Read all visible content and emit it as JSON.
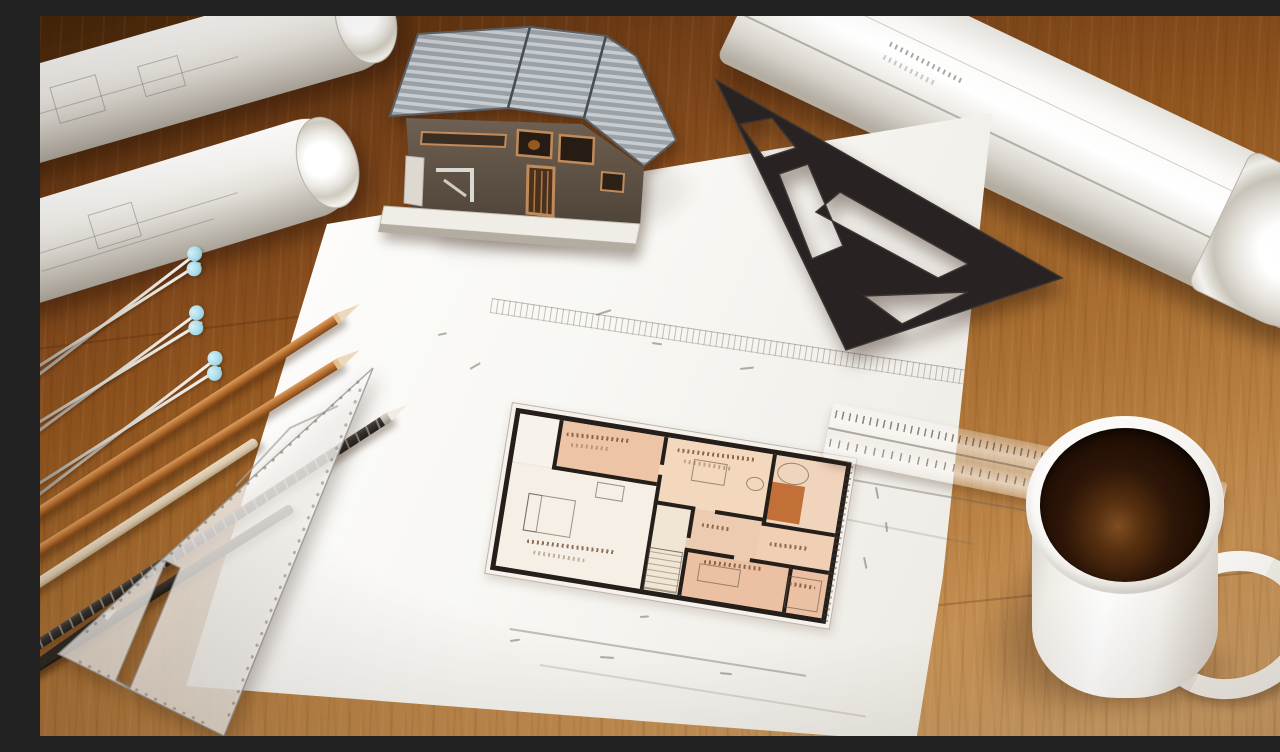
{
  "scene": {
    "description": "Top-down photo of an architect's wooden desk: two rolled blueprints top-left, a miniature house model with corrugated metal roof, a large rolled blueprint at top-right, a black drafting set square, a hand-drawn floor plan with peach colored rooms on a white sheet, copper and black pencils, silver drafting compasses with blue grips, a translucent triangle ruler, a translucent scale ruler, and a white mug of black coffee",
    "surface_label": "wooden desk",
    "visible_text": "none legible (handwritten plan labels and dimension figures are illegible scribbles)"
  },
  "palette": {
    "wood1": "#452608",
    "wood2": "#5f3310",
    "wood3": "#7b441a",
    "wood4": "#93561f",
    "wood5": "#a56a2d",
    "wood6": "#b57c3e",
    "wood7": "#c48f52",
    "wood8": "#cd9e66",
    "paper": "#f8f7f3",
    "paper_edge": "#e2ded6",
    "plan_wall": "#241f1a",
    "plan_peach": "#eec4a6",
    "plan_peach_light": "#f3d8be",
    "plan_cream": "#f5efe6",
    "plan_orange": "#c27038",
    "tri": "#282322",
    "roof_light": "#c7ccd0",
    "roof_mid": "#9aa1a7",
    "roof_edge": "#5a6065",
    "wall_brown": "#675a4d",
    "trim": "#c08a5a",
    "base": "#efede6",
    "copper": "#c07b3b",
    "tan": "#d8c6ab",
    "blackp": "#34302b",
    "blue": "#a9dcea",
    "silver": "#d8d4ca",
    "mug": "#f2efe9",
    "coffee": "#1c0c03",
    "coffee_hi": "#7e4d22"
  },
  "objects": {
    "table": {
      "label": "wooden desk surface"
    },
    "blueprint_roll_1": {
      "label": "rolled blueprint (top left, upper)"
    },
    "blueprint_roll_2": {
      "label": "rolled blueprint (top left, lower)"
    },
    "blueprint_roll_right": {
      "label": "large rolled blueprint (top right)"
    },
    "drawing_sheet": {
      "label": "large white drawing sheet"
    },
    "floor_plan": {
      "label": "hand-drawn floor plan with peach rooms"
    },
    "house_model": {
      "label": "miniature house model with corrugated roof"
    },
    "set_square": {
      "label": "black drafting set square"
    },
    "triangle_ruler": {
      "label": "translucent triangle ruler"
    },
    "scale_ruler": {
      "label": "translucent scale ruler"
    },
    "pencil_count": 6,
    "compass_count": 3,
    "coffee_mug": {
      "label": "white mug with black coffee"
    }
  },
  "layers": {
    "paper_marks": [
      {
        "l": 556,
        "t": 298,
        "w": 16,
        "r": -18
      },
      {
        "l": 612,
        "t": 326,
        "w": 10,
        "r": 8
      },
      {
        "l": 700,
        "t": 352,
        "w": 14,
        "r": -6
      },
      {
        "l": 430,
        "t": 352,
        "w": 12,
        "r": -30
      },
      {
        "l": 398,
        "t": 318,
        "w": 9,
        "r": -12
      },
      {
        "l": 836,
        "t": 470,
        "w": 12,
        "r": 80
      },
      {
        "l": 846,
        "t": 505,
        "w": 10,
        "r": 84
      },
      {
        "l": 824,
        "t": 540,
        "w": 12,
        "r": 78
      },
      {
        "l": 560,
        "t": 640,
        "w": 14,
        "r": 4
      },
      {
        "l": 470,
        "t": 624,
        "w": 10,
        "r": -8
      },
      {
        "l": 680,
        "t": 656,
        "w": 12,
        "r": 6
      },
      {
        "l": 600,
        "t": 600,
        "w": 9,
        "r": -4
      }
    ],
    "plan_rooms": [
      {
        "n": "plan-closet",
        "l": 9,
        "t": 9,
        "w": 40,
        "h": 48,
        "bg": "#f7f3ec"
      },
      {
        "n": "plan-room-top-left",
        "l": 49,
        "t": 9,
        "w": 106,
        "h": 50,
        "bg": "#eec4a6"
      },
      {
        "n": "plan-room-top-mid",
        "l": 155,
        "t": 9,
        "w": 110,
        "h": 66,
        "bg": "#f3d8be"
      },
      {
        "n": "plan-room-top-right",
        "l": 265,
        "t": 9,
        "w": 74,
        "h": 72,
        "bg": "#f0d4bc"
      },
      {
        "n": "plan-room-left-big",
        "l": 9,
        "t": 59,
        "w": 146,
        "h": 104,
        "bg": "#f5efe6"
      },
      {
        "n": "plan-hall",
        "l": 155,
        "t": 75,
        "w": 38,
        "h": 88,
        "bg": "#f1e5d4"
      },
      {
        "n": "plan-room-mid-small",
        "l": 193,
        "t": 75,
        "w": 72,
        "h": 44,
        "bg": "#edcbb0"
      },
      {
        "n": "plan-room-right-mid",
        "l": 265,
        "t": 81,
        "w": 74,
        "h": 38,
        "bg": "#f0cfb4"
      },
      {
        "n": "plan-room-bottom-right",
        "l": 193,
        "t": 119,
        "w": 146,
        "h": 44,
        "bg": "#ecc0a2"
      },
      {
        "n": "plan-orange-cabinet",
        "l": 268,
        "t": 36,
        "w": 34,
        "h": 38,
        "bg": "#c27038"
      }
    ],
    "plan_walls": [
      {
        "l": 49,
        "t": 9,
        "w": 4,
        "h": 50
      },
      {
        "l": 49,
        "t": 55,
        "w": 106,
        "h": 4
      },
      {
        "l": 155,
        "t": 9,
        "w": 4,
        "h": 28
      },
      {
        "l": 155,
        "t": 47,
        "w": 4,
        "h": 116
      },
      {
        "l": 155,
        "t": 73,
        "w": 42,
        "h": 4
      },
      {
        "l": 217,
        "t": 73,
        "w": 50,
        "h": 4
      },
      {
        "l": 265,
        "t": 9,
        "w": 4,
        "h": 72
      },
      {
        "l": 265,
        "t": 77,
        "w": 74,
        "h": 4
      },
      {
        "l": 193,
        "t": 75,
        "w": 4,
        "h": 30
      },
      {
        "l": 193,
        "t": 117,
        "w": 4,
        "h": 46
      },
      {
        "l": 193,
        "t": 115,
        "w": 50,
        "h": 4
      },
      {
        "l": 259,
        "t": 115,
        "w": 80,
        "h": 4
      },
      {
        "l": 299,
        "t": 119,
        "w": 4,
        "h": 44
      }
    ],
    "plan_furniture": [
      {
        "n": "plan-bed",
        "l": 30,
        "t": 86,
        "w": 46,
        "h": 36
      },
      {
        "n": "plan-pillow",
        "l": 30,
        "t": 86,
        "w": 12,
        "h": 36
      },
      {
        "n": "plan-table",
        "l": 188,
        "t": 26,
        "w": 32,
        "h": 20
      },
      {
        "n": "plan-tub",
        "l": 272,
        "t": 14,
        "w": 30,
        "h": 20,
        "br": "50%"
      },
      {
        "n": "plan-toilet",
        "l": 243,
        "t": 34,
        "w": 16,
        "h": 12,
        "br": "50%"
      },
      {
        "n": "plan-sofa",
        "l": 210,
        "t": 128,
        "w": 40,
        "h": 16
      },
      {
        "n": "plan-bed-2",
        "l": 300,
        "t": 126,
        "w": 32,
        "h": 30
      },
      {
        "n": "plan-desk",
        "l": 96,
        "t": 64,
        "w": 26,
        "h": 14
      },
      {
        "n": "plan-stairs",
        "l": 158,
        "t": 120,
        "w": 32,
        "h": 40
      }
    ],
    "plan_scribbles": [
      {
        "l": 58,
        "t": 20,
        "w": 64,
        "r": -3
      },
      {
        "l": 64,
        "t": 30,
        "w": 40,
        "r": -3,
        "o": 0.5
      },
      {
        "l": 170,
        "t": 18,
        "w": 78,
        "r": -2
      },
      {
        "l": 178,
        "t": 28,
        "w": 48,
        "o": 0.5
      },
      {
        "l": 36,
        "t": 132,
        "w": 88,
        "r": -2
      },
      {
        "l": 44,
        "t": 142,
        "w": 52,
        "o": 0.5
      },
      {
        "l": 214,
        "t": 124,
        "w": 58,
        "r": -2
      },
      {
        "l": 276,
        "t": 96,
        "w": 40,
        "r": -2
      },
      {
        "l": 206,
        "t": 88,
        "w": 28
      },
      {
        "l": 302,
        "t": 132,
        "w": 26
      }
    ],
    "pencils": [
      {
        "n": "pencil-copper-1",
        "kind": "copper",
        "l": -36,
        "t": 514,
        "w": 400,
        "r": -33
      },
      {
        "n": "pencil-copper-2",
        "kind": "copper",
        "l": -50,
        "t": 560,
        "w": 412,
        "r": -32
      },
      {
        "n": "pencil-tan",
        "kind": "tan",
        "l": -60,
        "t": 600,
        "w": 330,
        "r": -33
      },
      {
        "n": "pencil-black-speckled",
        "kind": "blackspeck",
        "l": -30,
        "t": 642,
        "w": 452,
        "r": -33
      },
      {
        "n": "pencil-black",
        "kind": "blackp",
        "l": -70,
        "t": 688,
        "w": 380,
        "r": -32
      },
      {
        "n": "pencil-dark-corner",
        "kind": "dark",
        "l": -140,
        "t": 740,
        "w": 250,
        "r": -35
      }
    ],
    "compasses": [
      {
        "n": "drafting-compass-1",
        "kind": "compass",
        "l": -10,
        "t": 352,
        "w": 205,
        "r": -35
      },
      {
        "n": "drafting-compass-2",
        "kind": "compass",
        "l": -16,
        "t": 412,
        "w": 212,
        "r": -34
      },
      {
        "n": "drafting-compass-3",
        "kind": "compass",
        "l": -6,
        "t": 468,
        "w": 225,
        "r": -35
      }
    ]
  }
}
